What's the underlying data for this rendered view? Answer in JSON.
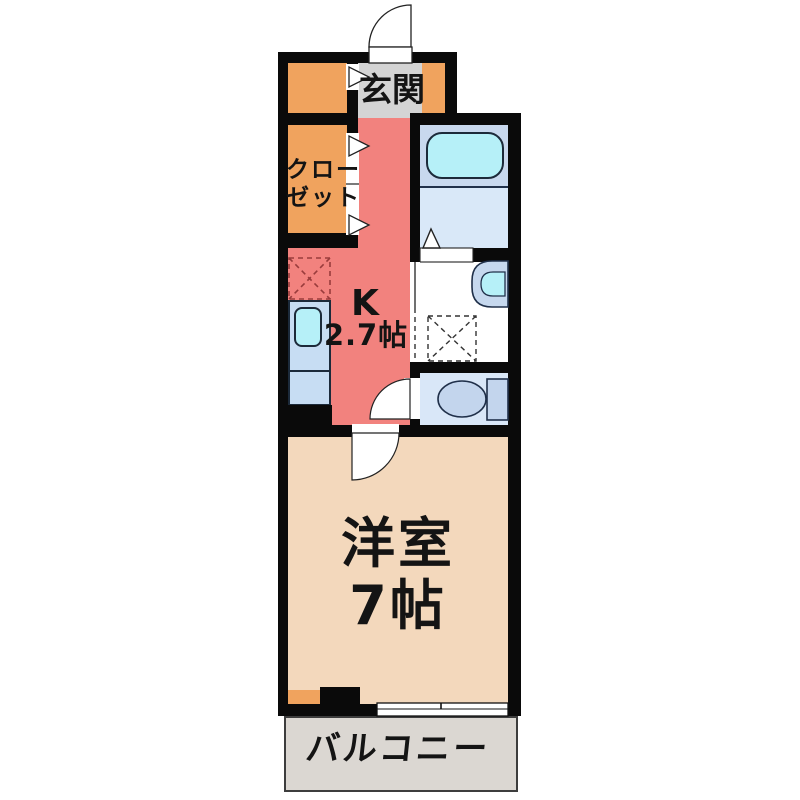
{
  "floorplan": {
    "rooms": {
      "entrance": {
        "label": "玄関"
      },
      "closet": {
        "label_line1": "クロー",
        "label_line2": "ゼット"
      },
      "kitchen": {
        "label": "K",
        "size": "2.7帖"
      },
      "western_room": {
        "label": "洋室",
        "size": "7帖"
      },
      "balcony": {
        "label": "バルコニー"
      }
    },
    "fixtures": [
      "bathtub",
      "washbasin",
      "washing-machine-pan",
      "toilet",
      "kitchen-sink-counter",
      "refrigerator-space",
      "entrance-door",
      "closet-folding-doors",
      "bath-folding-door",
      "washroom-sliding-door",
      "toilet-door",
      "western-room-door",
      "balcony-sliding-window"
    ],
    "colors": {
      "wall": "#0a0a0a",
      "entrance": "#d4d4d4",
      "closet_storage": "#f0a35e",
      "kitchen": "#f2827e",
      "western_room": "#f3d8bc",
      "balcony": "#dbd7d2",
      "bath_floor": "#c8d8ee",
      "bath_floor_light": "#d9e8f8",
      "water_fixture": "#b6f0f8",
      "ceramic_fixture": "#c3d5ed",
      "text": "#141414"
    }
  }
}
